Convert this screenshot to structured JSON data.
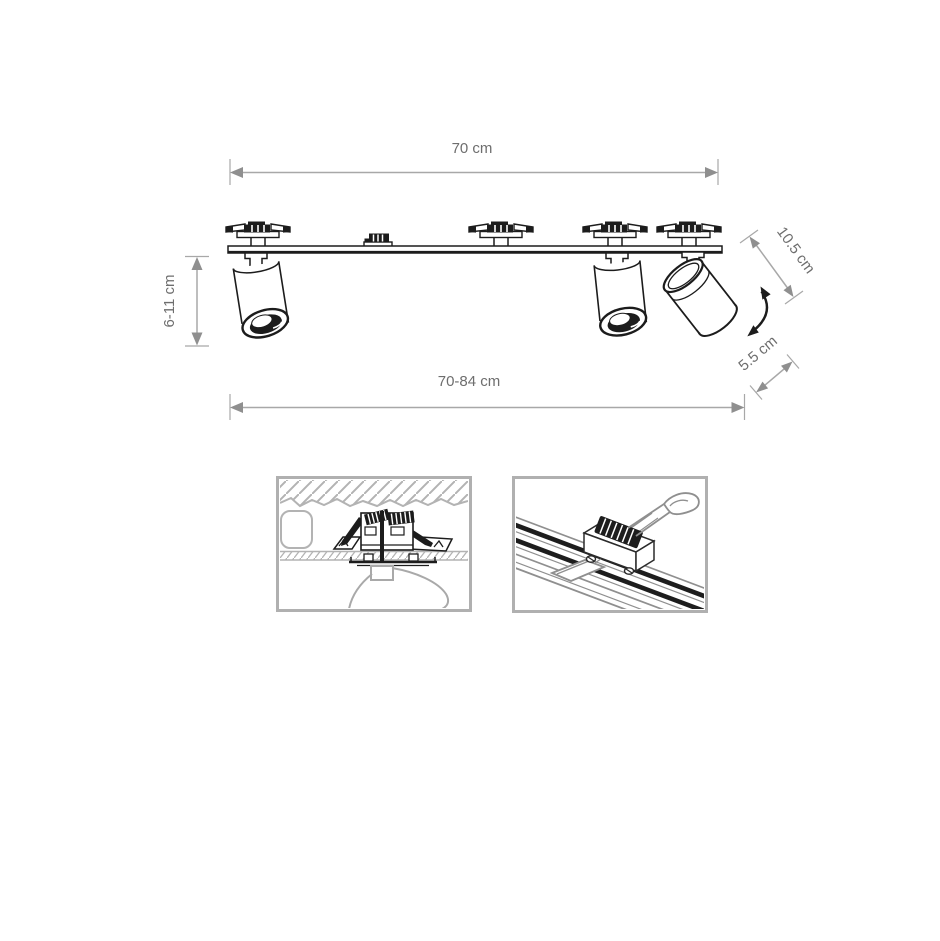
{
  "diagram": {
    "subject": "three-spot ceiling mount light fixture technical drawing",
    "colors": {
      "background": "#ffffff",
      "drawing_line": "#1c1c1c",
      "dimension_line": "#a8a8a8",
      "dimension_arrow": "#8f8f8f",
      "dimension_text": "#6e6e6e",
      "inset_line": "#b0b0b0",
      "inset_dark": "#1d1d1d"
    },
    "dimensions": {
      "width_top": {
        "label": "70 cm"
      },
      "height_left": {
        "label": "6-11 cm"
      },
      "spot_length_diagonal": {
        "label": "10.5 cm"
      },
      "spot_offset_diagonal": {
        "label": "5.5 cm"
      },
      "width_bottom": {
        "label": "70-84 cm"
      }
    },
    "icons": {
      "rotation_arrow": "curved-double-headed-arrow",
      "dimension_arrow": "double-headed-arrow"
    },
    "insets": {
      "left": "recessed-ceiling-mount-detail",
      "right": "track-rail-mount-detail"
    }
  }
}
